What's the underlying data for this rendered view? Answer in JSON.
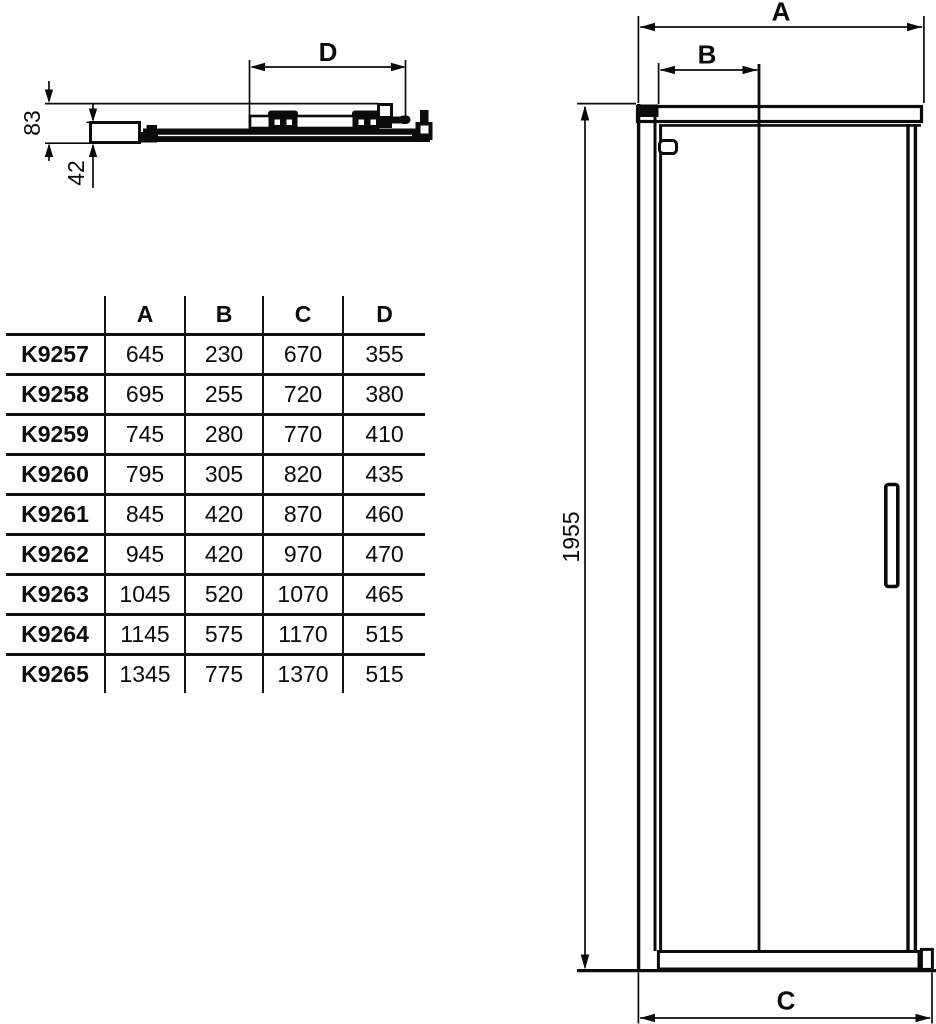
{
  "section_view": {
    "dim_width_label": "D",
    "dim_total_depth": "83",
    "dim_glass_depth": "42"
  },
  "size_table": {
    "corner_label": "",
    "col_headers": [
      "A",
      "B",
      "C",
      "D"
    ],
    "rows": [
      {
        "model": "K9257",
        "a": "645",
        "b": "230",
        "c": "670",
        "d": "355"
      },
      {
        "model": "K9258",
        "a": "695",
        "b": "255",
        "c": "720",
        "d": "380"
      },
      {
        "model": "K9259",
        "a": "745",
        "b": "280",
        "c": "770",
        "d": "410"
      },
      {
        "model": "K9260",
        "a": "795",
        "b": "305",
        "c": "820",
        "d": "435"
      },
      {
        "model": "K9261",
        "a": "845",
        "b": "420",
        "c": "870",
        "d": "460"
      },
      {
        "model": "K9262",
        "a": "945",
        "b": "420",
        "c": "970",
        "d": "470"
      },
      {
        "model": "K9263",
        "a": "1045",
        "b": "520",
        "c": "1070",
        "d": "465"
      },
      {
        "model": "K9264",
        "a": "1145",
        "b": "575",
        "c": "1170",
        "d": "515"
      },
      {
        "model": "K9265",
        "a": "1345",
        "b": "775",
        "c": "1370",
        "d": "515"
      }
    ]
  },
  "elevation_view": {
    "dim_overall_width": "A",
    "dim_door_width": "B",
    "dim_base_width": "C",
    "dim_height": "1955"
  },
  "colors": {
    "line": "#0b0b0b",
    "background": "#ffffff"
  }
}
